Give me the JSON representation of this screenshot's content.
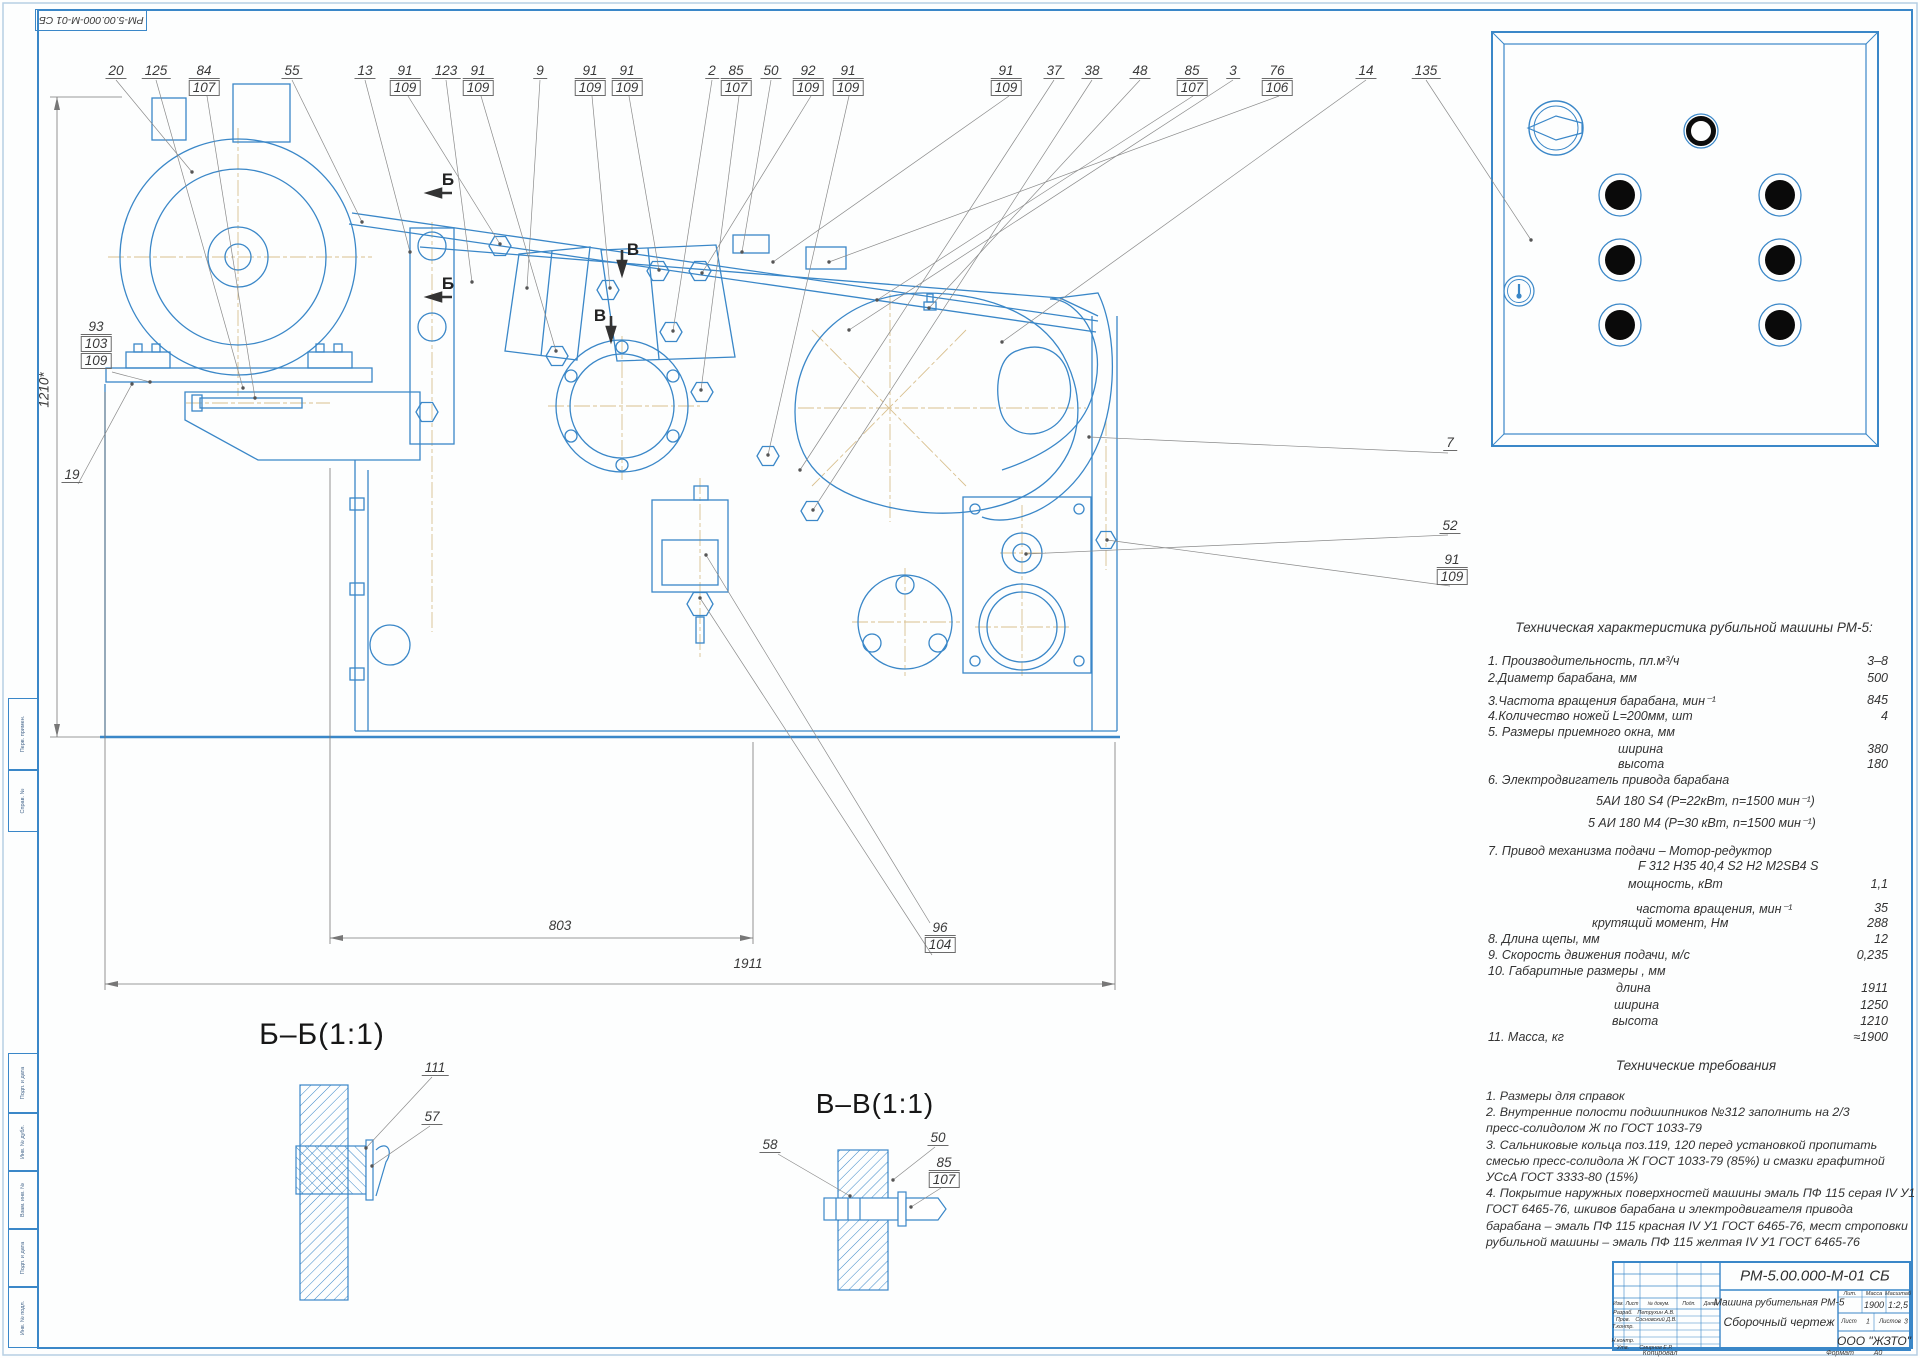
{
  "corner_stamp": "РМ-5.00.000-М-01 СБ",
  "margin_stamps": [
    {
      "label": "Перв. примен.",
      "y": 698,
      "h": 72
    },
    {
      "label": "Справ. №",
      "y": 770,
      "h": 62
    },
    {
      "label": "Подп. и дата",
      "y": 1053,
      "h": 60
    },
    {
      "label": "Инв. № дубл.",
      "y": 1113,
      "h": 58
    },
    {
      "label": "Взам. инв. №",
      "y": 1171,
      "h": 58
    },
    {
      "label": "Подп. и дата",
      "y": 1229,
      "h": 58
    },
    {
      "label": "Инв. № подл.",
      "y": 1287,
      "h": 61
    }
  ],
  "callouts": [
    {
      "x": 116,
      "lines": [
        {
          "t": "20"
        }
      ]
    },
    {
      "x": 156,
      "lines": [
        {
          "t": "125"
        }
      ]
    },
    {
      "x": 204,
      "lines": [
        {
          "t": "84"
        },
        {
          "t": "107",
          "box": true
        }
      ]
    },
    {
      "x": 292,
      "lines": [
        {
          "t": "55"
        }
      ]
    },
    {
      "x": 365,
      "lines": [
        {
          "t": "13"
        }
      ]
    },
    {
      "x": 405,
      "lines": [
        {
          "t": "91"
        },
        {
          "t": "109",
          "box": true
        }
      ]
    },
    {
      "x": 446,
      "lines": [
        {
          "t": "123"
        }
      ]
    },
    {
      "x": 478,
      "lines": [
        {
          "t": "91"
        },
        {
          "t": "109",
          "box": true
        }
      ]
    },
    {
      "x": 540,
      "lines": [
        {
          "t": "9"
        }
      ]
    },
    {
      "x": 590,
      "lines": [
        {
          "t": "91"
        },
        {
          "t": "109",
          "box": true
        }
      ]
    },
    {
      "x": 627,
      "lines": [
        {
          "t": "91"
        },
        {
          "t": "109",
          "box": true
        }
      ]
    },
    {
      "x": 712,
      "lines": [
        {
          "t": "2"
        }
      ]
    },
    {
      "x": 736,
      "lines": [
        {
          "t": "85"
        },
        {
          "t": "107",
          "box": true
        }
      ]
    },
    {
      "x": 771,
      "lines": [
        {
          "t": "50"
        }
      ]
    },
    {
      "x": 808,
      "lines": [
        {
          "t": "92"
        },
        {
          "t": "109",
          "box": true
        }
      ]
    },
    {
      "x": 848,
      "lines": [
        {
          "t": "91"
        },
        {
          "t": "109",
          "box": true
        }
      ]
    },
    {
      "x": 1006,
      "lines": [
        {
          "t": "91"
        },
        {
          "t": "109",
          "box": true
        }
      ]
    },
    {
      "x": 1054,
      "lines": [
        {
          "t": "37"
        }
      ]
    },
    {
      "x": 1092,
      "lines": [
        {
          "t": "38"
        }
      ]
    },
    {
      "x": 1140,
      "lines": [
        {
          "t": "48"
        }
      ]
    },
    {
      "x": 1192,
      "lines": [
        {
          "t": "85"
        },
        {
          "t": "107",
          "box": true
        }
      ]
    },
    {
      "x": 1233,
      "lines": [
        {
          "t": "3"
        }
      ]
    },
    {
      "x": 1277,
      "lines": [
        {
          "t": "76"
        },
        {
          "t": "106",
          "box": true
        }
      ]
    },
    {
      "x": 1366,
      "lines": [
        {
          "t": "14"
        }
      ]
    },
    {
      "x": 1426,
      "lines": [
        {
          "t": "135"
        }
      ]
    },
    {
      "x": 96,
      "y": 320,
      "lines": [
        {
          "t": "93"
        },
        {
          "t": "103",
          "box": true
        },
        {
          "t": "109",
          "box": true
        }
      ]
    },
    {
      "x": 72,
      "y": 468,
      "lines": [
        {
          "t": "19"
        }
      ]
    },
    {
      "x": 1450,
      "y": 436,
      "lines": [
        {
          "t": "7"
        }
      ]
    },
    {
      "x": 1450,
      "y": 519,
      "lines": [
        {
          "t": "52"
        }
      ]
    },
    {
      "x": 1452,
      "y": 553,
      "lines": [
        {
          "t": "91"
        },
        {
          "t": "109",
          "box": true
        }
      ]
    },
    {
      "x": 940,
      "y": 921,
      "lines": [
        {
          "t": "96"
        },
        {
          "t": "104",
          "box": true
        }
      ]
    },
    {
      "x": 435,
      "y": 1061,
      "lines": [
        {
          "t": "111"
        }
      ]
    },
    {
      "x": 432,
      "y": 1110,
      "lines": [
        {
          "t": "57"
        }
      ]
    },
    {
      "x": 770,
      "y": 1138,
      "lines": [
        {
          "t": "58"
        }
      ]
    },
    {
      "x": 938,
      "y": 1131,
      "lines": [
        {
          "t": "50"
        }
      ]
    },
    {
      "x": 944,
      "y": 1156,
      "lines": [
        {
          "t": "85"
        },
        {
          "t": "107",
          "box": true
        }
      ]
    }
  ],
  "section_markers": [
    {
      "t": "Б",
      "x": 448,
      "y": 170
    },
    {
      "t": "Б",
      "x": 448,
      "y": 274
    },
    {
      "t": "В",
      "x": 633,
      "y": 240
    },
    {
      "t": "В",
      "x": 600,
      "y": 306
    }
  ],
  "section_views": {
    "bb": "Б–Б(1:1)",
    "vv": "В–В(1:1)"
  },
  "dimensions": {
    "overall_length": "1911",
    "motor_span": "803",
    "overall_height": "1210*"
  },
  "tech_spec": {
    "title": "Техническая характеристика рубильной машины РМ-5:",
    "rows": [
      {
        "y": 654,
        "ind": 0,
        "label": "1. Производительность, пл.м³/ч",
        "value": "3–8"
      },
      {
        "y": 671,
        "ind": 0,
        "label": "2.Диаметр барабана, мм",
        "value": "500"
      },
      {
        "y": 693,
        "ind": 0,
        "label": "3.Частота вращения барабана, мин⁻¹",
        "value": "845"
      },
      {
        "y": 709,
        "ind": 0,
        "label": "4.Количество ножей L=200мм, шт",
        "value": "4"
      },
      {
        "y": 725,
        "ind": 0,
        "label": "5. Размеры приемного окна, мм",
        "value": ""
      },
      {
        "y": 742,
        "ind": 130,
        "label": "ширина",
        "value": "380"
      },
      {
        "y": 757,
        "ind": 130,
        "label": "высота",
        "value": "180"
      },
      {
        "y": 773,
        "ind": 0,
        "label": "6. Электродвигатель привода барабана",
        "value": ""
      },
      {
        "y": 793,
        "ind": 108,
        "label": "5АИ 180 S4  (P=22кВт, n=1500 мин⁻¹)",
        "value": ""
      },
      {
        "y": 815,
        "ind": 100,
        "label": "5 АИ 180 М4 (P=30 кВт, n=1500 мин⁻¹)",
        "value": ""
      },
      {
        "y": 844,
        "ind": 0,
        "label": "7. Привод механизма подачи – Мотор-редуктор",
        "value": ""
      },
      {
        "y": 859,
        "ind": 150,
        "label": "F 312 H35 40,4 S2 H2 M2SB4 S",
        "value": ""
      },
      {
        "y": 877,
        "ind": 140,
        "label": "мощность, кВт",
        "value": "1,1"
      },
      {
        "y": 901,
        "ind": 148,
        "label": "частота вращения, мин⁻¹",
        "value": "35"
      },
      {
        "y": 916,
        "ind": 104,
        "label": "крутящий момент, Нм",
        "value": "288"
      },
      {
        "y": 932,
        "ind": 0,
        "label": "8. Длина щепы, мм",
        "value": "12"
      },
      {
        "y": 948,
        "ind": 0,
        "label": "9. Скорость движения подачи, м/с",
        "value": "0,235"
      },
      {
        "y": 964,
        "ind": 0,
        "label": "10. Габаритные размеры , мм",
        "value": ""
      },
      {
        "y": 981,
        "ind": 128,
        "label": "длина",
        "value": "1911"
      },
      {
        "y": 998,
        "ind": 126,
        "label": "ширина",
        "value": "1250"
      },
      {
        "y": 1014,
        "ind": 124,
        "label": "высота",
        "value": "1210"
      },
      {
        "y": 1030,
        "ind": 0,
        "label": "11. Масса, кг",
        "value": "≈1900"
      }
    ]
  },
  "tech_req": {
    "title": "Технические требования",
    "lines": [
      "1. Размеры для справок",
      "2. Внутренние полости подшипников №312 заполнить на 2/3",
      "пресс-солидолом Ж по ГОСТ 1033-79",
      "3. Сальниковые кольца поз.119, 120 перед установкой пропитать",
      "смесью пресс-солидола Ж ГОСТ 1033-79 (85%) и смазки графитной",
      "УСсА ГОСТ 3333-80 (15%)",
      "4. Покрытие наружных поверхностей машины эмаль ПФ 115 серая IV У1",
      "ГОСТ 6465-76, шкивов барабана и электродвигателя привода",
      "барабана – эмаль ПФ 115 красная IV У1 ГОСТ 6465-76, мест строповки",
      "рубильной машины – эмаль ПФ 115 желтая IV У1 ГОСТ 6465-76"
    ]
  },
  "title_block": {
    "doc_number": "РМ-5.00.000-М-01 СБ",
    "product": "Машина рубительная РМ-5",
    "doc_type": "Сборочный чертеж",
    "header_cols": [
      "Изм.",
      "Лист",
      "№ докум.",
      "Подп.",
      "Дата"
    ],
    "staff": [
      {
        "role": "Разраб.",
        "name": "Петрухин А.В."
      },
      {
        "role": "Пров.",
        "name": "Сосновский Д.В."
      },
      {
        "role": "Т.контр.",
        "name": ""
      },
      {
        "role": "",
        "name": ""
      },
      {
        "role": "Н.контр.",
        "name": ""
      },
      {
        "role": "Утв.",
        "name": "Смирнов Е.Р."
      }
    ],
    "lit_label": "Лит.",
    "mass_label": "Масса",
    "scale_label": "Масштаб",
    "mass": "1900",
    "scale": "1:2,5",
    "sheet_label": "Лист",
    "sheet": "1",
    "sheets_label": "Листов",
    "sheets": "3",
    "company": "ООО \"ЖЗТО\"",
    "copied": "Копировал",
    "format_label": "Формат",
    "format": "А0"
  }
}
